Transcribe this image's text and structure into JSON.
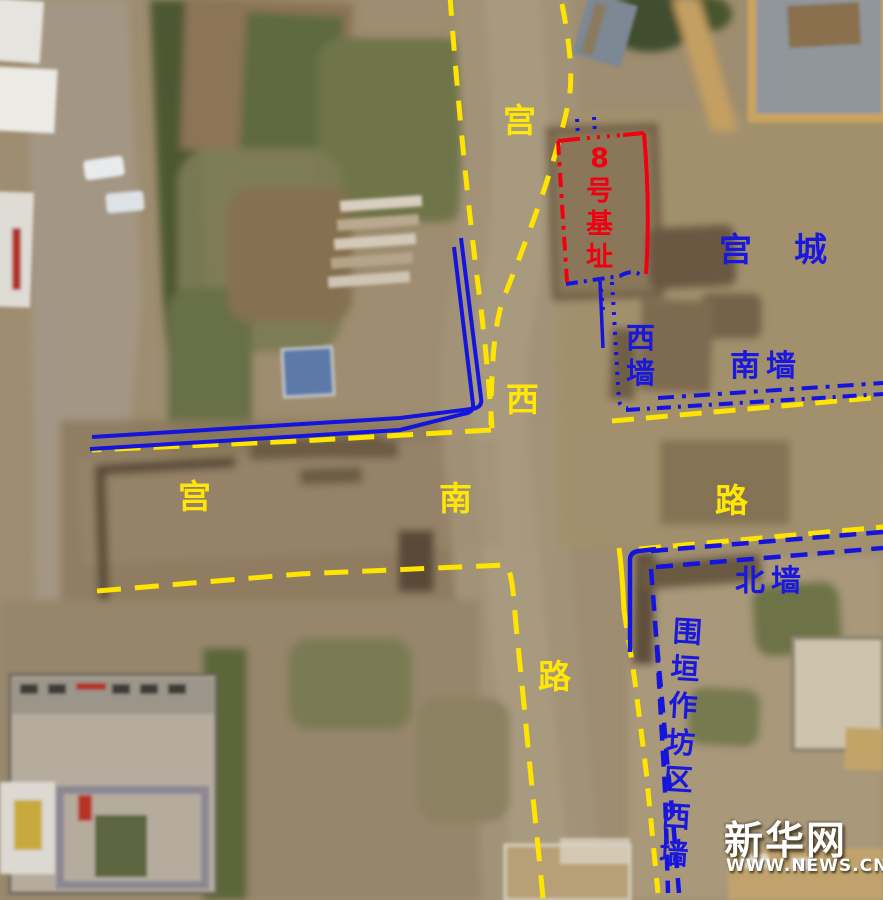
{
  "image_type": "annotated aerial photograph of archaeological site",
  "annotations": {
    "roads": {
      "line_color": "#ffe400",
      "line_style": "dashed",
      "north_south_road": {
        "name": "宫西路",
        "chars": [
          "宫",
          "西",
          "路"
        ]
      },
      "east_west_road": {
        "name": "宫南路",
        "chars": [
          "宫",
          "南",
          "路"
        ]
      }
    },
    "palace_city": {
      "line_color": "#1414dd",
      "name": "宫城",
      "west_wall": "西墙",
      "south_wall": "南墙"
    },
    "workshop_enclosure": {
      "line_color": "#1414dd",
      "north_wall": "北墙",
      "west_wall": "围垣作坊区西墙"
    },
    "foundation": {
      "line_color": "#f20010",
      "name": "8号基址"
    }
  },
  "watermark": {
    "brand": "新华网",
    "url": "WWW.NEWS.CN"
  }
}
